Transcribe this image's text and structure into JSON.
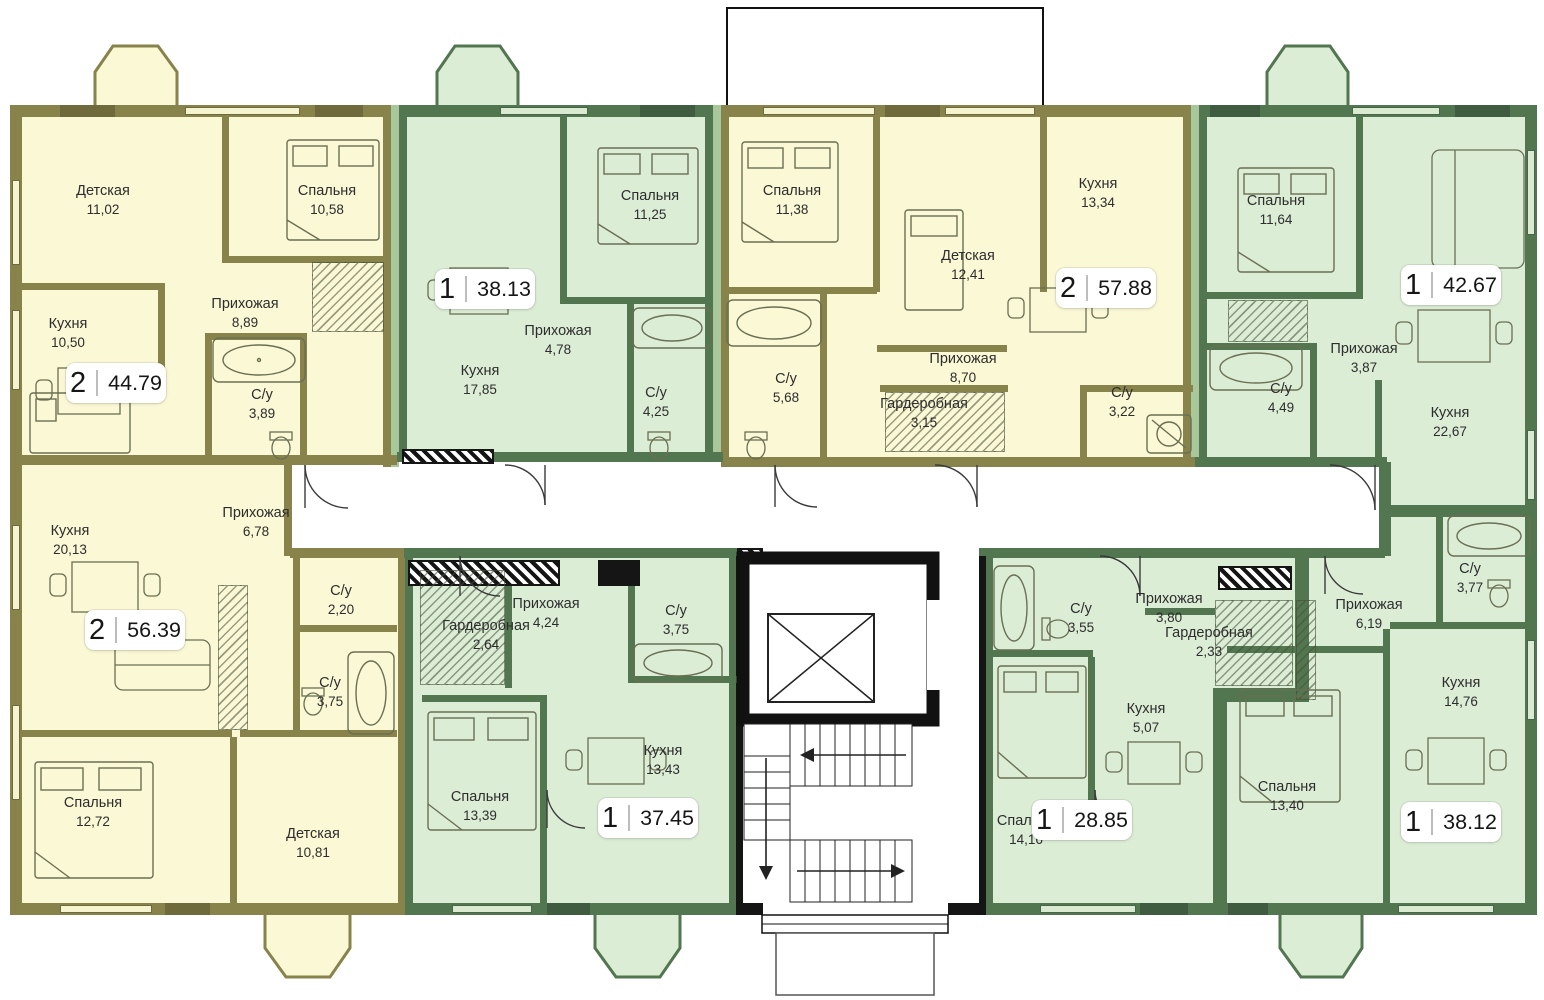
{
  "plan_title": "Residential floor plan",
  "colors": {
    "apartment_2room_fill": "#FAF8D5",
    "apartment_2room_wall": "#87834B",
    "apartment_1room_fill": "#DCEDD6",
    "apartment_1room_wall": "#527650",
    "core_wall": "#151515",
    "corridor_fill": "#FFFFFF"
  },
  "apartments": [
    {
      "id": 1,
      "kind": "2-room",
      "rooms_count": "2",
      "total_area": "44.79",
      "rooms": [
        {
          "name": "Детская",
          "area": "11,02"
        },
        {
          "name": "Спальня",
          "area": "10,58"
        },
        {
          "name": "Кухня",
          "area": "10,50"
        },
        {
          "name": "Прихожая",
          "area": "8,89"
        },
        {
          "name": "С/у",
          "area": "3,89"
        }
      ]
    },
    {
      "id": 2,
      "kind": "1-room",
      "rooms_count": "1",
      "total_area": "38.13",
      "rooms": [
        {
          "name": "Спальня",
          "area": "11,25"
        },
        {
          "name": "Прихожая",
          "area": "4,78"
        },
        {
          "name": "Кухня",
          "area": "17,85"
        },
        {
          "name": "С/у",
          "area": "4,25"
        }
      ]
    },
    {
      "id": 3,
      "kind": "2-room",
      "rooms_count": "2",
      "total_area": "57.88",
      "rooms": [
        {
          "name": "Спальня",
          "area": "11,38"
        },
        {
          "name": "Детская",
          "area": "12,41"
        },
        {
          "name": "Кухня",
          "area": "13,34"
        },
        {
          "name": "С/у",
          "area": "5,68"
        },
        {
          "name": "Прихожая",
          "area": "8,70"
        },
        {
          "name": "Гардеробная",
          "area": "3,15"
        },
        {
          "name": "С/у",
          "area": "3,22"
        }
      ]
    },
    {
      "id": 4,
      "kind": "1-room",
      "rooms_count": "1",
      "total_area": "42.67",
      "rooms": [
        {
          "name": "Спальня",
          "area": "11,64"
        },
        {
          "name": "Прихожая",
          "area": "3,87"
        },
        {
          "name": "С/у",
          "area": "4,49"
        },
        {
          "name": "Кухня",
          "area": "22,67"
        }
      ]
    },
    {
      "id": 5,
      "kind": "2-room",
      "rooms_count": "2",
      "total_area": "56.39",
      "rooms": [
        {
          "name": "Кухня",
          "area": "20,13"
        },
        {
          "name": "Прихожая",
          "area": "6,78"
        },
        {
          "name": "С/у",
          "area": "2,20"
        },
        {
          "name": "С/у",
          "area": "3,75"
        },
        {
          "name": "Спальня",
          "area": "12,72"
        },
        {
          "name": "Детская",
          "area": "10,81"
        }
      ]
    },
    {
      "id": 6,
      "kind": "1-room",
      "rooms_count": "1",
      "total_area": "37.45",
      "rooms": [
        {
          "name": "Прихожая",
          "area": "4,24"
        },
        {
          "name": "Гардеробная",
          "area": "2,64"
        },
        {
          "name": "С/у",
          "area": "3,75"
        },
        {
          "name": "Кухня",
          "area": "13,43"
        },
        {
          "name": "Спальня",
          "area": "13,39"
        }
      ]
    },
    {
      "id": 7,
      "kind": "1-room",
      "rooms_count": "1",
      "total_area": "28.85",
      "rooms": [
        {
          "name": "С/у",
          "area": "3,55"
        },
        {
          "name": "Прихожая",
          "area": "3,80"
        },
        {
          "name": "Гардеробная",
          "area": "2,33"
        },
        {
          "name": "Кухня",
          "area": "5,07"
        },
        {
          "name": "Спальня",
          "area": "14,16"
        }
      ]
    },
    {
      "id": 8,
      "kind": "1-room",
      "rooms_count": "1",
      "total_area": "38.12",
      "rooms": [
        {
          "name": "Прихожая",
          "area": "6,19"
        },
        {
          "name": "С/у",
          "area": "3,77"
        },
        {
          "name": "Кухня",
          "area": "14,76"
        },
        {
          "name": "Спальня",
          "area": "13,40"
        }
      ]
    }
  ]
}
